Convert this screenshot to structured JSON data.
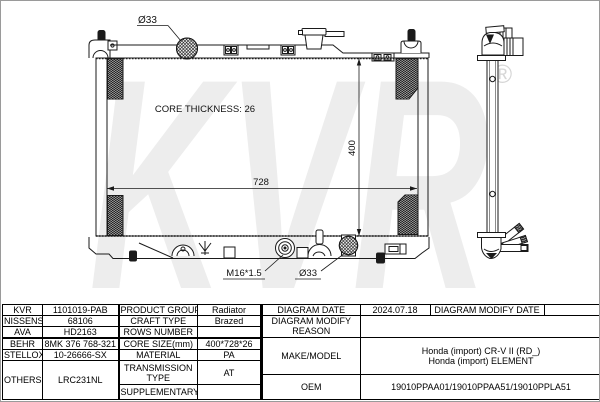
{
  "page": {
    "background": "#ffffff",
    "line_color": "#1a1a1a",
    "watermark_color": "#ededed"
  },
  "drawing": {
    "watermark": {
      "text": "KVR",
      "registered": "®"
    },
    "labels": {
      "top_inlet_diameter": "Ø33",
      "core_thickness": "CORE THICKNESS: 26",
      "core_width_mm": "728",
      "core_height_mm": "400",
      "drain_plug_thread": "M16*1.5",
      "bottom_outlet_diameter": "Ø33"
    }
  },
  "table": {
    "brands": [
      {
        "name": "KVR",
        "number": "1101019-PAB"
      },
      {
        "name": "NISSENS",
        "number": "68106"
      },
      {
        "name": "AVA",
        "number": "HD2163"
      },
      {
        "name": "BEHR",
        "number": "8MK 376 768-321"
      },
      {
        "name": "STELLOX",
        "number": "10-26666-SX"
      },
      {
        "name": "OTHERS",
        "number": "LRC231NL"
      }
    ],
    "specs": [
      {
        "label": "PRODUCT GROUP",
        "value": "Radiator"
      },
      {
        "label": "CRAFT TYPE",
        "value": "Brazed"
      },
      {
        "label": "ROWS NUMBER",
        "value": ""
      },
      {
        "label": "CORE SIZE(mm)",
        "value": "400*728*26"
      },
      {
        "label": "MATERIAL",
        "value": "PA"
      },
      {
        "label": "TRANSMISSION TYPE",
        "value": "AT"
      },
      {
        "label": "SUPPLEMENTARY",
        "value": ""
      }
    ],
    "diagram": {
      "date_label": "DIAGRAM DATE",
      "date": "2024.07.18",
      "modify_date_label": "DIAGRAM MODIFY DATE",
      "modify_date": "",
      "modify_reason_label": "DIAGRAM MODIFY REASON",
      "modify_reason": ""
    },
    "make_model": {
      "label": "MAKE/MODEL",
      "models": [
        "Honda (import) CR-V II (RD_)",
        "Honda (import) ELEMENT"
      ]
    },
    "oem": {
      "label": "OEM",
      "numbers": "19010PPAA01/19010PPAA51/19010PPLA51"
    }
  }
}
